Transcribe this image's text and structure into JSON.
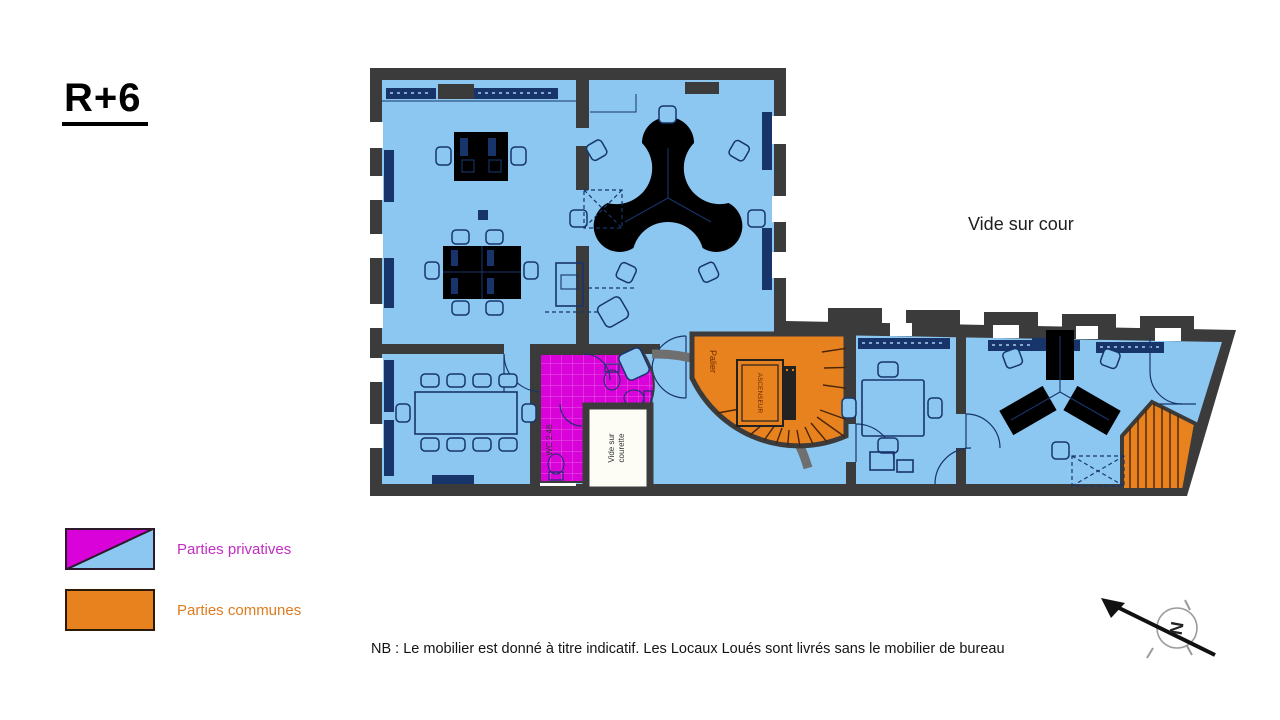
{
  "title": "R+6",
  "plan": {
    "outside_label": "Vide sur cour",
    "labels": {
      "palier": "Palier",
      "ascenseur": "ASCENSEUR",
      "vide_courette_line1": "Vide sur",
      "vide_courette_line2": "courette",
      "wc": "WC 2.46"
    },
    "colors": {
      "private_blue": "#8cc7f2",
      "private_magenta": "#d903d9",
      "common_orange": "#e8821e",
      "wall": "#3b3b3b"
    }
  },
  "legend": {
    "items": [
      {
        "label": "Parties privatives",
        "color": "#c32cc3"
      },
      {
        "label": "Parties communes",
        "color": "#de7b1e"
      }
    ]
  },
  "note": "NB : Le mobilier est donné à titre indicatif. Les Locaux Loués sont livrés sans le mobilier de bureau",
  "compass": {
    "north_label": "N"
  }
}
